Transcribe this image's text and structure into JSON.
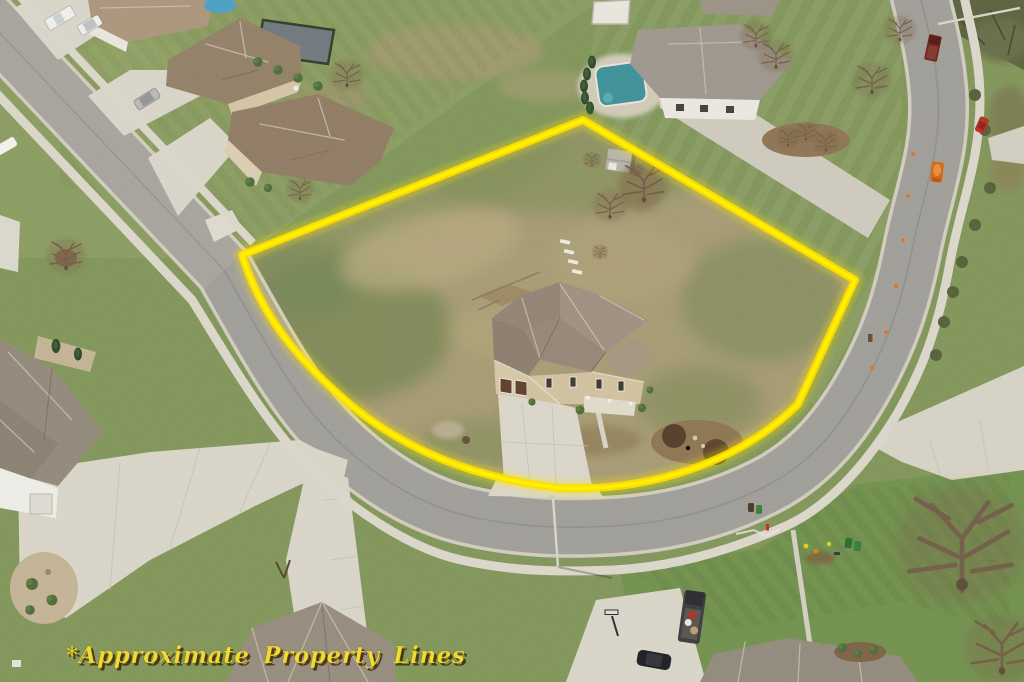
{
  "annotation": {
    "text": "*Approximate Property Lines",
    "text_color": "#F0DB36",
    "shadow_color": "#3E2C08"
  },
  "boundary": {
    "color": "#FFDD00",
    "glow_color": "#FFE800",
    "style": "thick solid outline with soft glow tracing the lot perimeter"
  },
  "palette": {
    "healthy_grass": "#7E935A",
    "dry_lot_grass": "#A39872",
    "asphalt_road": "#9D9B96",
    "concrete": "#D7D3C7",
    "roof_brown": "#8F7D66",
    "roof_gray": "#9A948A",
    "pool_water": "#3F8E97"
  },
  "scene": {
    "type": "aerial-drone-photograph",
    "subject": "corner residential lot outlined in yellow containing a two-story home with driveway and rear shed",
    "objects": [
      "subject-house",
      "subject-driveway",
      "storage-shed",
      "curved-suburban-street",
      "sidewalks",
      "neighbor-houses",
      "swimming-pools",
      "fenced-sport-court",
      "bare-trees",
      "mulch-islands",
      "parked-vehicles",
      "utility-workers",
      "trash-bins",
      "streetlight",
      "basketball-hoop",
      "annotation-text"
    ]
  }
}
